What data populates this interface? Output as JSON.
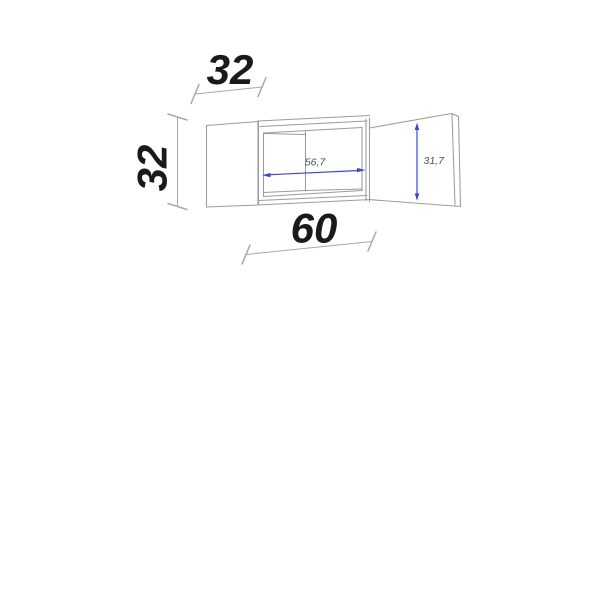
{
  "dimensions": {
    "depth": "32",
    "height": "32",
    "width": "60",
    "interior_width": "56,7",
    "door_height": "31,7"
  },
  "colors": {
    "background": "#ffffff",
    "drawing_line": "#9b9b9b",
    "dimension_line": "#a8a8a8",
    "dimension_text": "#1a1a1a",
    "accent_blue": "#3e49c6",
    "small_label_text": "#4f4f4f"
  }
}
